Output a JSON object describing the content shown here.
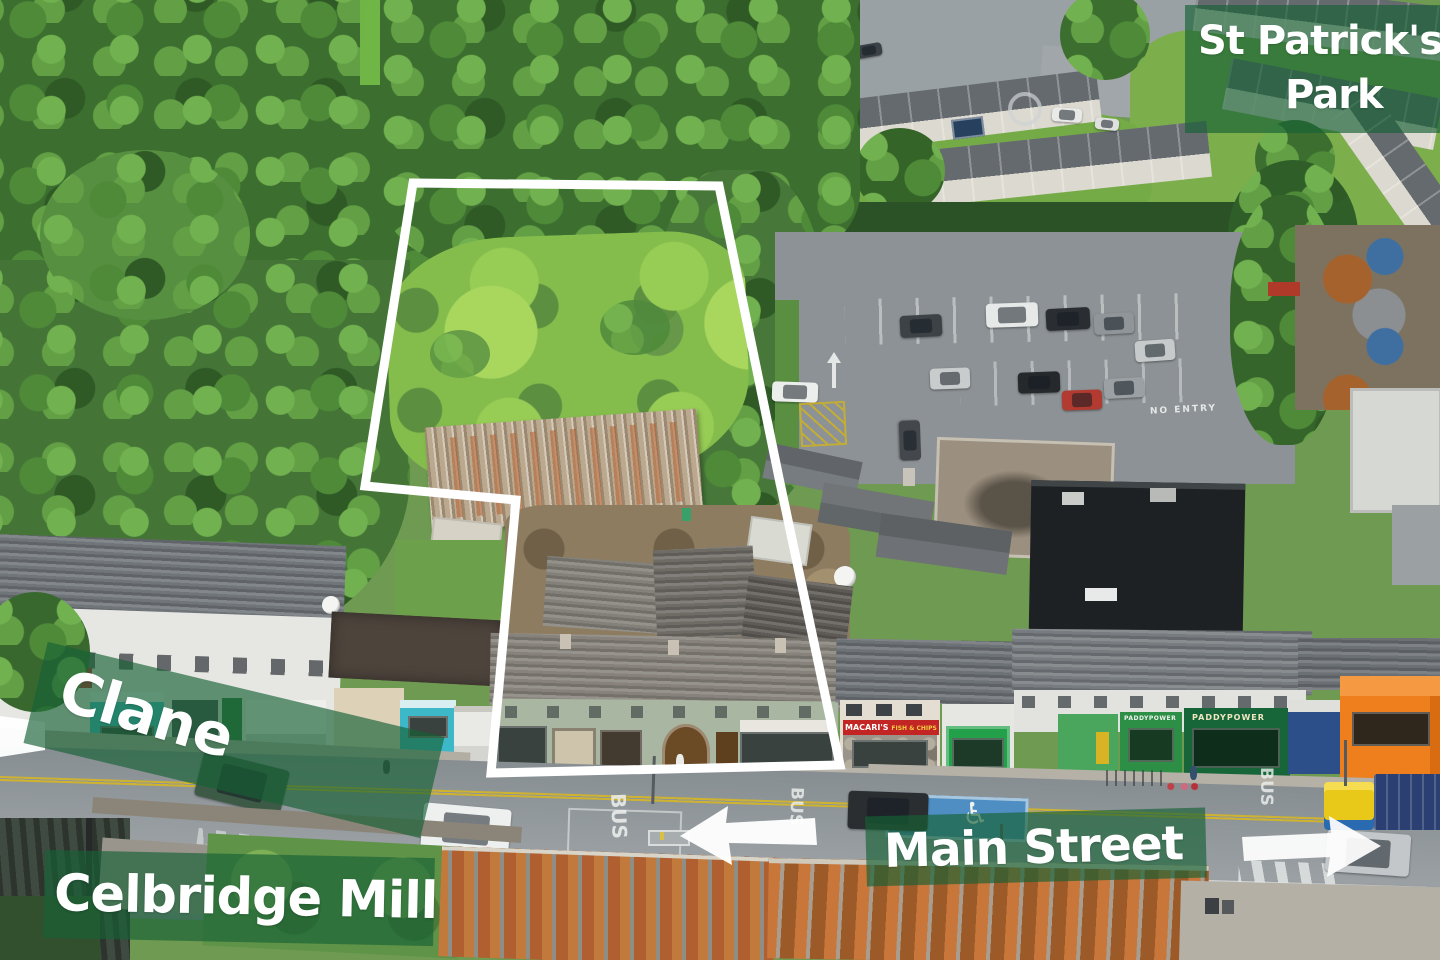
{
  "annotations": {
    "overlay_color": "#176135",
    "boundary_color": "#ffffff",
    "labels": {
      "st_patricks_line1": "St Patrick's",
      "st_patricks_line2": "Park",
      "clane": "Clane",
      "celbridge_mill": "Celbridge Mill",
      "main_street": "Main Street"
    },
    "arrows": {
      "main_street_left": "left",
      "main_street_right": "right",
      "clane_left": "left"
    }
  },
  "boundary": {
    "points": "413,183 719,186 779,478 840,765 491,773 516,500 365,486"
  },
  "road_markings": {
    "bus": "BUS",
    "loading": "LOADING",
    "no_entry": "NO ENTRY",
    "disabled_icon": "♿"
  },
  "signs": {
    "macaris": "MACARI'S",
    "macaris_sub": "FISH & CHIPS",
    "paddypower": "PADDYPOWER"
  }
}
